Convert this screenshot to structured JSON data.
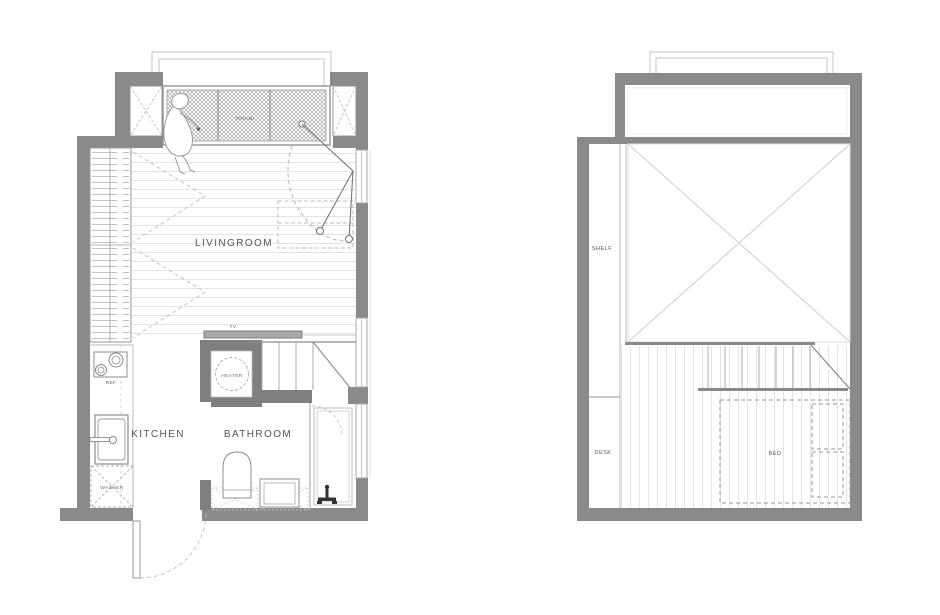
{
  "page": {
    "background": "#ffffff",
    "type": "architectural floor plan, two levels side by side"
  },
  "palette": {
    "wall": "#8a8a8a",
    "wall_dark": "#7f7f7f",
    "line_dark": "#777777",
    "line": "#aaaaaa",
    "floor_line": "#e4e4e4",
    "label": "#4a4a4a"
  },
  "left_plan": {
    "name": "ground-floor-plan",
    "labels": {
      "livingroom": "LIVINGROOM",
      "kitchen": "KITCHEN",
      "bathroom": "BATHROOM",
      "tatami": "TATAMI",
      "heater": "HEATER",
      "tv": "TV",
      "ref": "REF",
      "washer": "WASHER"
    }
  },
  "right_plan": {
    "name": "loft-floor-plan",
    "labels": {
      "shelf": "SHELF",
      "desk": "DESK",
      "bed": "BED"
    }
  }
}
